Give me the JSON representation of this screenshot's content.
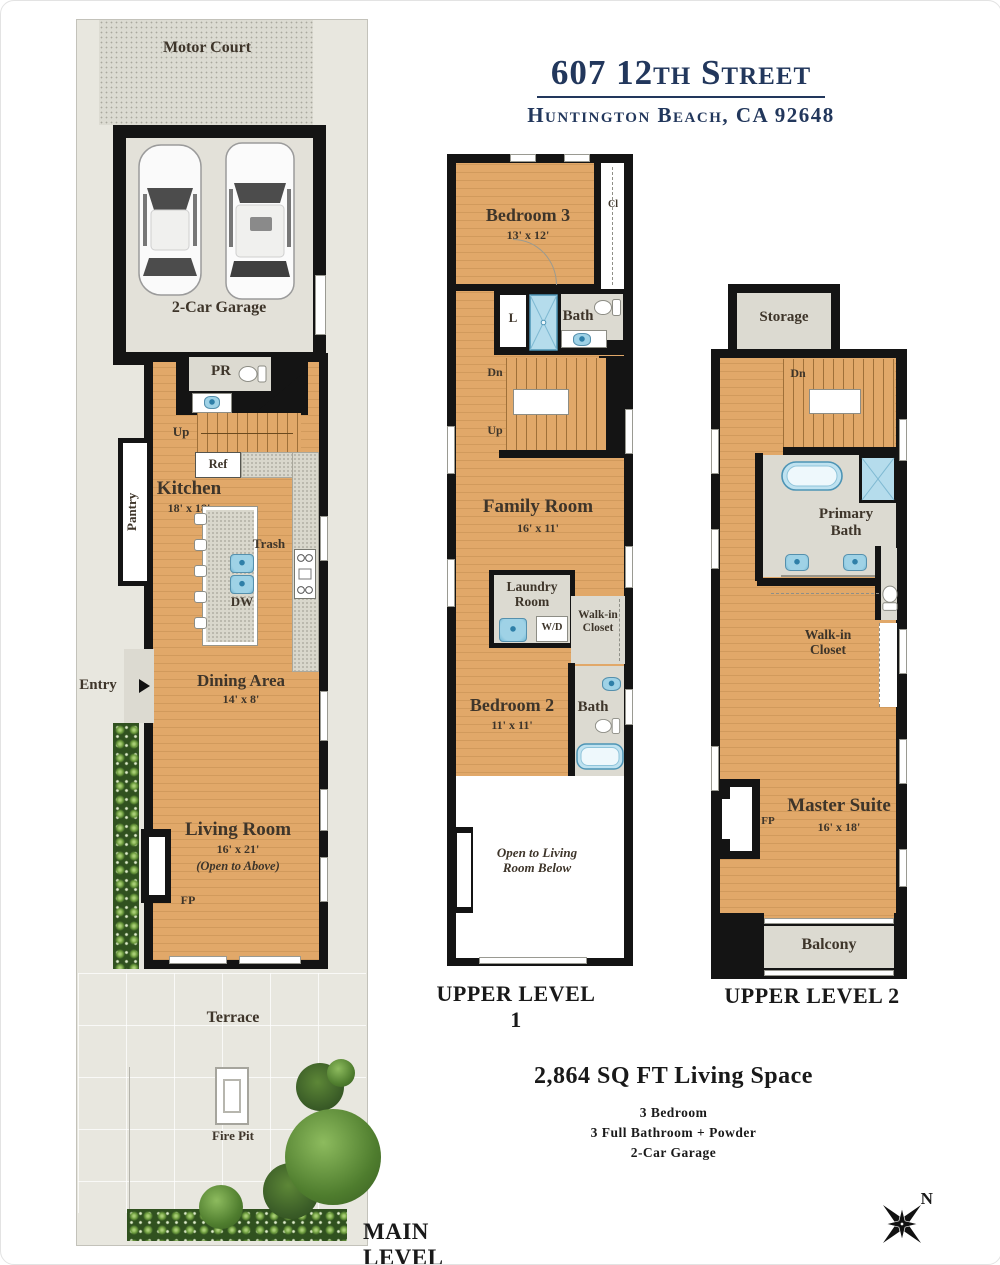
{
  "title": {
    "line1": "607 12th Street",
    "line2": "Huntington Beach, CA 92648"
  },
  "main_level": {
    "level_label": "MAIN LEVEL",
    "motor_court": "Motor Court",
    "garage": "2-Car Garage",
    "pr": "PR",
    "up": "Up",
    "ref": "Ref",
    "kitchen": {
      "name": "Kitchen",
      "dims": "18' x 18'"
    },
    "pantry": "Pantry",
    "trash": "Trash",
    "dw": "DW",
    "entry": "Entry",
    "dining": {
      "name": "Dining Area",
      "dims": "14' x 8'"
    },
    "living": {
      "name": "Living Room",
      "dims": "16' x 21'",
      "note": "(Open to Above)"
    },
    "fp": "FP",
    "terrace": "Terrace",
    "fire_pit": "Fire Pit"
  },
  "upper_level_1": {
    "level_label": "UPPER LEVEL 1",
    "bedroom3": {
      "name": "Bedroom 3",
      "dims": "13' x 12'"
    },
    "closet": "Cl",
    "linen": "L",
    "bath_top": "Bath",
    "dn": "Dn",
    "up": "Up",
    "family": {
      "name": "Family Room",
      "dims": "16' x 11'"
    },
    "laundry": "Laundry Room",
    "wd": "W/D",
    "walkin": "Walk-in Closet",
    "bedroom2": {
      "name": "Bedroom 2",
      "dims": "11' x 11'"
    },
    "bath_bottom": "Bath",
    "open_note": "Open to Living Room Below"
  },
  "upper_level_2": {
    "level_label": "UPPER LEVEL 2",
    "storage": "Storage",
    "dn": "Dn",
    "primary_bath": "Primary Bath",
    "walkin": "Walk-in Closet",
    "master": {
      "name": "Master Suite",
      "dims": "16' x 18'"
    },
    "fp": "FP",
    "balcony": "Balcony"
  },
  "summary": {
    "sqft": "2,864 SQ FT Living Space",
    "detail1": "3 Bedroom",
    "detail2": "3 Full Bathroom + Powder",
    "detail3": "2-Car Garage"
  },
  "compass": {
    "north": "N"
  },
  "colors": {
    "wood_floor": "#e1a869",
    "wall": "#141414",
    "service_gray": "#dcdad1",
    "fixture_blue": "#9fd2e6",
    "lot_gray": "#e8e7df",
    "title_navy": "#22375c",
    "room_label": "#3e352a"
  }
}
